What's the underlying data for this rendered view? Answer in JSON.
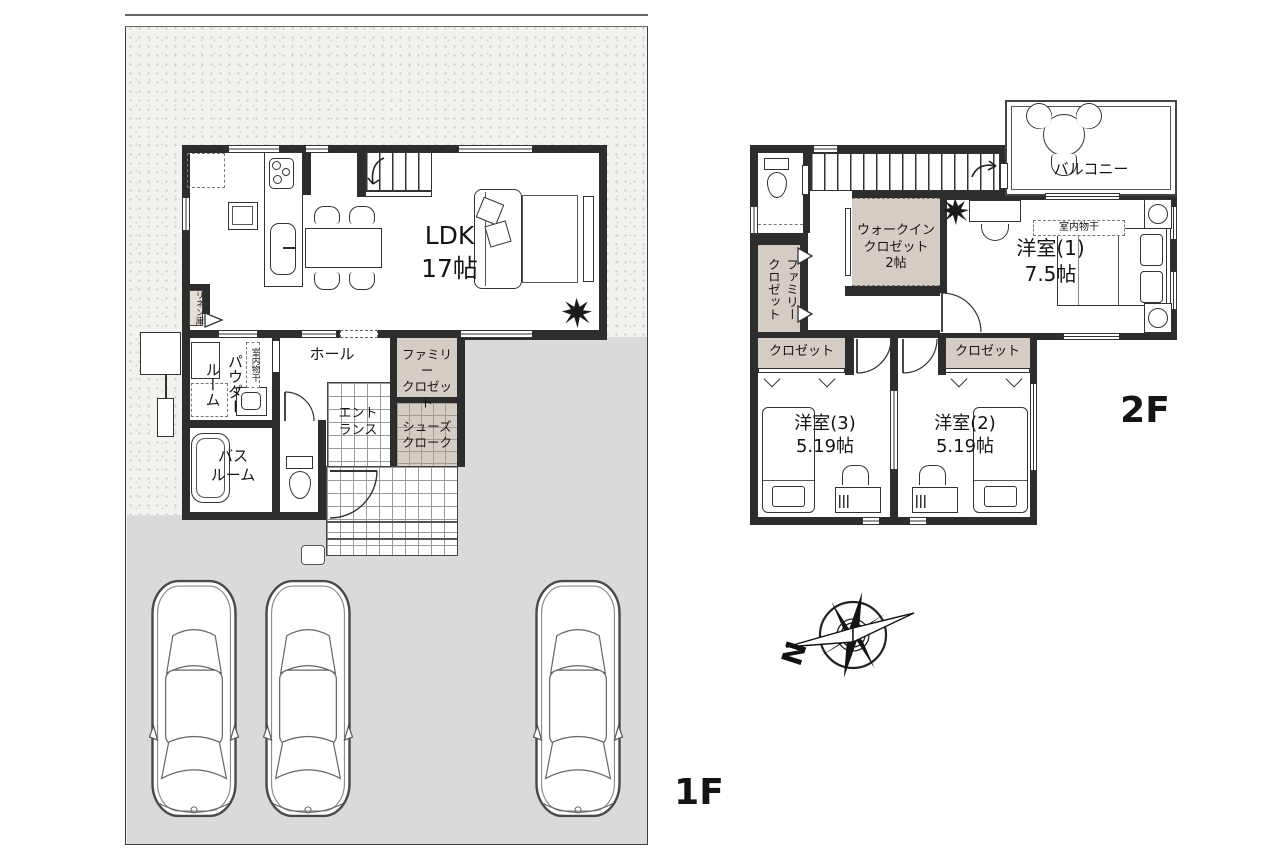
{
  "colors": {
    "wall": "#2d2d2d",
    "closet_fill": "#d5ccc4",
    "driveway": "#dadada",
    "gravel": "#f3f2ef"
  },
  "floor1": {
    "label": "1F",
    "ldk": "LDK\n17帖",
    "hall": "ホール",
    "entrance": "エント\nランス",
    "family_closet": "ファミリー\nクロゼット",
    "shoes_cloak": "シューズ\nクローク",
    "powder_room": "パウダー\nルーム",
    "bath_room": "バス\nルーム",
    "linen": "リネン庫",
    "indoor_drying": "室内物干"
  },
  "floor2": {
    "label": "2F",
    "room1": "洋室(1)\n7.5帖",
    "room2": "洋室(2)\n5.19帖",
    "room3": "洋室(3)\n5.19帖",
    "walk_in_closet": "ウォークイン\nクロゼット\n2帖",
    "family_closet": "ファミリー\nクロゼット",
    "closet_left": "クロゼット",
    "closet_right": "クロゼット",
    "balcony": "バルコニー",
    "indoor_drying": "室内物干"
  },
  "compass": {
    "north": "N"
  }
}
